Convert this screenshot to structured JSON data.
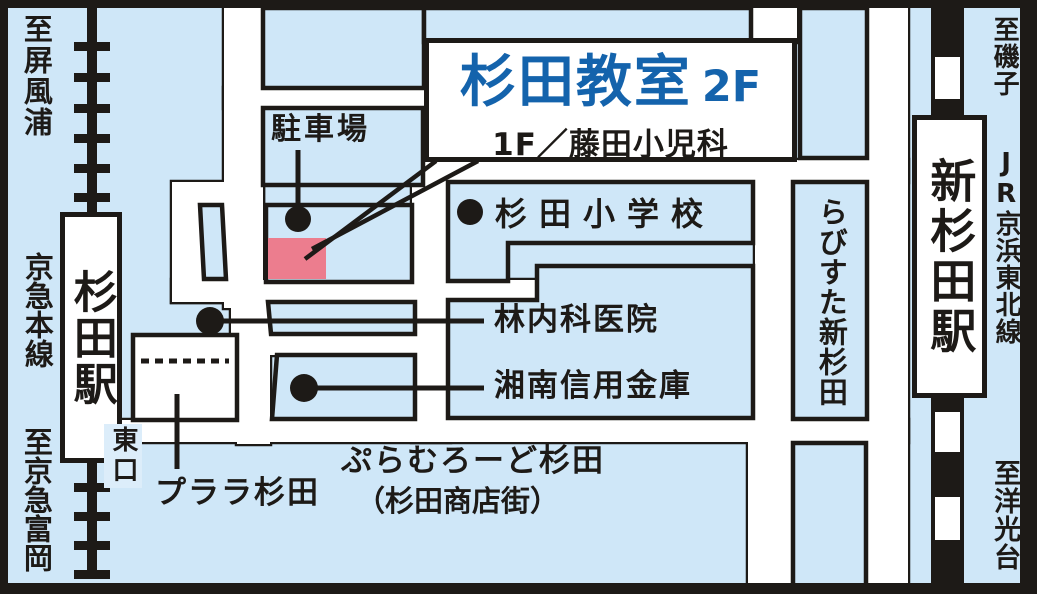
{
  "title_box": {
    "name": "杉田教室",
    "floor": "2F",
    "first_floor": "1F／藤田小児科"
  },
  "stations": {
    "sugita": "杉田駅",
    "shin_sugita": "新杉田駅"
  },
  "rail_lines": {
    "keikyu": "京急本線",
    "jr": "JR京浜東北線"
  },
  "directions": {
    "byobugaura": "至屏風浦",
    "keikyu_tomioka": "至京急富岡",
    "isogo": "至磯子",
    "yokodai": "至洋光台"
  },
  "places": {
    "parking": "駐車場",
    "school": "杉田小学校",
    "clinic": "林内科医院",
    "bank": "湘南信用金庫",
    "rabisuta": "らびすた新杉田",
    "purara": "プララ杉田",
    "shopping_street_line1": "ぷらむろーど杉田",
    "shopping_street_line2": "（杉田商店街）",
    "east_exit": "東口"
  },
  "colors": {
    "background_blue": "#cfe7f8",
    "line_black": "#1d1a17",
    "road_white": "#ffffff",
    "target_red": "#ec7d8e",
    "title_blue": "#1463ac",
    "exit_badge_blue": "#dcedfa"
  }
}
